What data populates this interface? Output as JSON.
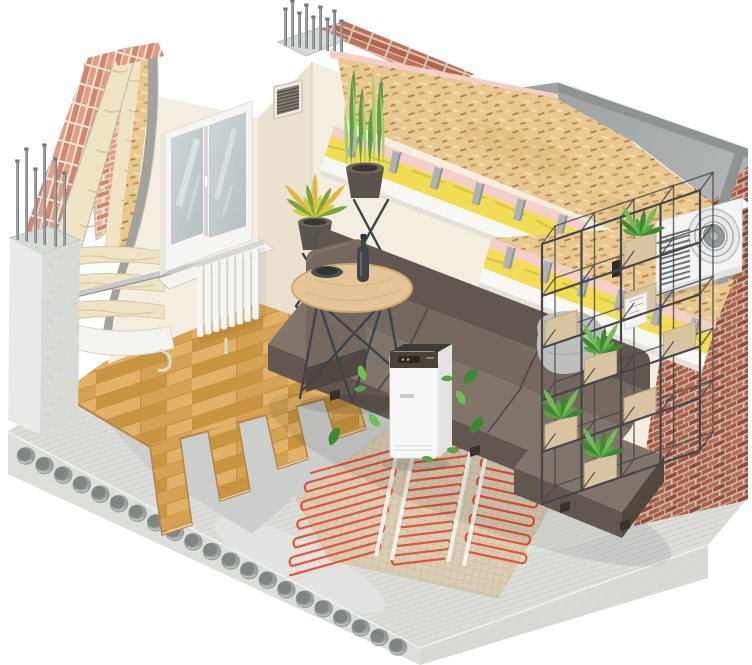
{
  "illustration": {
    "kind": "isometric-room-construction-cutaway",
    "visible_text": ""
  },
  "palette": {
    "bg": "#ffffff",
    "wall": "#f3eedf",
    "wall_shade": "#eae2cf",
    "wall_dark": "#e2d9c4",
    "brick_pink": "#df9e85",
    "brick_pink2": "#d0886d",
    "brick_pink3": "#e8b49e",
    "mortar": "#ede5d8",
    "brick_red": "#b66148",
    "brick_red2": "#a14f38",
    "brick_red3": "#c27157",
    "mortar2": "#d2c8ba",
    "concrete": "#e9eae7",
    "concrete2": "#d8dad6",
    "concrete3": "#c3c6c2",
    "slab_face": "#dcdeda",
    "hole": "#9aa09d",
    "hole2": "#7e8582",
    "screed": "#a4a8a9",
    "screed2": "#8e9394",
    "rough": "#dcddd9",
    "rough_line": "#c6c9c4",
    "osb": "#e7c891",
    "osb_sp1": "#c99e5a",
    "osb_sp2": "#b28347",
    "osb_sp3": "#f3ddac",
    "wool_yellow": "#f1dd55",
    "wool_yellow2": "#d2bb3b",
    "wool_cream": "#efe3c6",
    "wool_cream2": "#d9c7a0",
    "pink_board": "#f3cfc7",
    "white_board": "#f8f7f3",
    "channel": "#aeb2b4",
    "channel2": "#8d9294",
    "wood": "#d5a153",
    "wood2": "#c9943f",
    "wood3": "#e1b165",
    "wood_seam": "#aa7c36",
    "wood_edge": "#b3874a",
    "wood_edge_light": "#f0ddc0",
    "underlay": "#cccecb",
    "mesh": "#dacdb5",
    "mesh_line": "#c2b292",
    "cable": "#e84b2e",
    "tape": "#f7f6f2",
    "sofa": "#74685f",
    "sofa_light": "#80746b",
    "sofa_dark": "#615650",
    "sofa_deep": "#52483f",
    "pillow": "#bebfbd",
    "pillow_shade": "#a8a9a7",
    "table_top": "#e3c597",
    "table_rim": "#c9a76e",
    "wire": "#3e444c",
    "purifier": "#f7f8f8",
    "purifier_side": "#e2e4e4",
    "purifier_top": "#494338",
    "amber": "#e59b3c",
    "leaf": "#57a443",
    "leaf_dark": "#3f8833",
    "leaf_light": "#6fbf55",
    "plant": "#5c9e48",
    "plant_light": "#a6cd6c",
    "croton1": "#cbd03f",
    "croton2": "#e2b63b",
    "croton3": "#7ba43c",
    "pot": "#5a544e",
    "pot_rim": "#6c665f",
    "metal": "#c7c9c8",
    "rebar": "#9aa0a4",
    "rebar_dark": "#74797e",
    "shelf": "#45474a",
    "shelf_wood": "#d9c4a2",
    "shelf_wood_top": "#e9d9bb",
    "shelf_wood_side": "#c2a87e",
    "ac": "#f3f4f3",
    "ac_shade": "#dfe1e0",
    "ac_dark": "#6e7275",
    "radiator": "#f5f5f2",
    "radiator_shade": "#d7d7d2",
    "glass": "#b7bfc3",
    "glass_light": "#ced5d8",
    "slat": "#5a564e",
    "membrane": "#a3a19b",
    "sheet": "#f4f3ed"
  },
  "counts": {
    "slab_holes": 21,
    "pillar_rebar": 6,
    "column_rebar": 9,
    "radiator_fins": 8,
    "grille_slats": 7,
    "cable_runs": [
      12,
      13,
      12
    ],
    "ceiling_channels": [
      6,
      6
    ],
    "shelf_rows": 5,
    "shelf_cols": 4,
    "shelf_boxes": 8,
    "shelf_plants": 4,
    "floor_steps": 5,
    "wool_batts": 3,
    "floating_leaves": 10,
    "snake_leaves": 9,
    "croton_leaves": 11,
    "ac_fan_rings": 3,
    "ac_louvers": 10
  }
}
